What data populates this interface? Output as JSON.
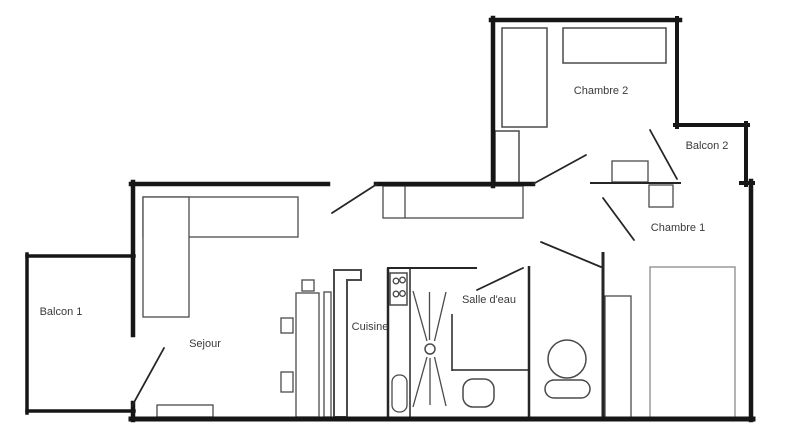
{
  "canvas": {
    "width": 800,
    "height": 447,
    "background": "#ffffff"
  },
  "colors": {
    "wall": "#161616",
    "interior_wall": "#262626",
    "furniture": "#4a4a4a",
    "furniture_light": "#8a8a8a",
    "label": "#3a3a3a",
    "fill": "#ffffff"
  },
  "rooms": [
    {
      "id": "balcon-1",
      "label": "Balcon 1",
      "x": 61,
      "y": 315
    },
    {
      "id": "sejour",
      "label": "Sejour",
      "x": 205,
      "y": 347
    },
    {
      "id": "cuisine",
      "label": "Cuisine",
      "x": 370,
      "y": 330
    },
    {
      "id": "salle-deau",
      "label": "Salle d'eau",
      "x": 489,
      "y": 303
    },
    {
      "id": "chambre-2",
      "label": "Chambre 2",
      "x": 601,
      "y": 94
    },
    {
      "id": "balcon-2",
      "label": "Balcon 2",
      "x": 707,
      "y": 149
    },
    {
      "id": "chambre-1",
      "label": "Chambre 1",
      "x": 678,
      "y": 231
    }
  ],
  "walls": {
    "exterior": [
      {
        "name": "wall-chambre2-top",
        "x1": 491,
        "y1": 20,
        "x2": 680,
        "y2": 20,
        "w": 4.5
      },
      {
        "name": "wall-chambre2-left",
        "x1": 493,
        "y1": 18,
        "x2": 493,
        "y2": 186,
        "w": 4.5
      },
      {
        "name": "wall-chambre2-right",
        "x1": 677,
        "y1": 18,
        "x2": 677,
        "y2": 127,
        "w": 4
      },
      {
        "name": "wall-balcon2-top",
        "x1": 675,
        "y1": 125,
        "x2": 748,
        "y2": 125,
        "w": 4
      },
      {
        "name": "wall-balcon2-right",
        "x1": 746,
        "y1": 123,
        "x2": 746,
        "y2": 185,
        "w": 4
      },
      {
        "name": "wall-right-jog",
        "x1": 741,
        "y1": 183,
        "x2": 753,
        "y2": 183,
        "w": 4
      },
      {
        "name": "wall-apartment-right",
        "x1": 751,
        "y1": 181,
        "x2": 751,
        "y2": 420,
        "w": 4.5
      },
      {
        "name": "wall-apartment-bottom",
        "x1": 131,
        "y1": 419,
        "x2": 753,
        "y2": 419,
        "w": 5
      },
      {
        "name": "wall-sejour-top",
        "x1": 131,
        "y1": 184,
        "x2": 328,
        "y2": 184,
        "w": 4.5
      },
      {
        "name": "wall-hall-top",
        "x1": 376,
        "y1": 184,
        "x2": 533,
        "y2": 184,
        "w": 4.5
      },
      {
        "name": "wall-apartment-left",
        "x1": 133,
        "y1": 182,
        "x2": 133,
        "y2": 335,
        "w": 4.5
      },
      {
        "name": "wall-left-stub",
        "x1": 133,
        "y1": 403,
        "x2": 133,
        "y2": 420,
        "w": 4.5
      },
      {
        "name": "wall-balcon1-top",
        "x1": 27,
        "y1": 256,
        "x2": 134,
        "y2": 256,
        "w": 3.5
      },
      {
        "name": "wall-balcon1-left",
        "x1": 27,
        "y1": 254,
        "x2": 27,
        "y2": 413,
        "w": 3.5
      },
      {
        "name": "wall-balcon1-bottom",
        "x1": 27,
        "y1": 411,
        "x2": 134,
        "y2": 411,
        "w": 3.5
      }
    ],
    "interior": [
      {
        "name": "wall-chambre1-top",
        "x1": 590,
        "y1": 183,
        "x2": 681,
        "y2": 183,
        "w": 2
      },
      {
        "name": "wall-wc-left",
        "x1": 529,
        "y1": 266,
        "x2": 529,
        "y2": 418,
        "w": 2.5
      },
      {
        "name": "wall-chambre1-left",
        "x1": 603,
        "y1": 252,
        "x2": 603,
        "y2": 418,
        "w": 3
      },
      {
        "name": "wall-cuisine-left",
        "x1": 388,
        "y1": 268,
        "x2": 388,
        "y2": 417,
        "w": 2.5
      },
      {
        "name": "wall-cuisine-top",
        "x1": 387,
        "y1": 268,
        "x2": 477,
        "y2": 268,
        "w": 2
      },
      {
        "name": "wall-shower-left",
        "x1": 410,
        "y1": 268,
        "x2": 410,
        "y2": 417,
        "w": 1.5
      },
      {
        "name": "wall-toilet-nook-v",
        "x1": 452,
        "y1": 314,
        "x2": 452,
        "y2": 371,
        "w": 1.5
      },
      {
        "name": "wall-toilet-nook-h",
        "x1": 452,
        "y1": 370,
        "x2": 529,
        "y2": 370,
        "w": 1.5
      }
    ]
  },
  "doors": [
    {
      "name": "door-balcon1",
      "x1": 132,
      "y1": 406,
      "x2": 164,
      "y2": 348
    },
    {
      "name": "door-entry",
      "x1": 332,
      "y1": 213,
      "x2": 377,
      "y2": 184
    },
    {
      "name": "door-chambre2",
      "x1": 533,
      "y1": 184,
      "x2": 586,
      "y2": 155
    },
    {
      "name": "door-balcon2",
      "x1": 650,
      "y1": 130,
      "x2": 677,
      "y2": 179
    },
    {
      "name": "door-chambre1",
      "x1": 603,
      "y1": 198,
      "x2": 634,
      "y2": 240
    },
    {
      "name": "door-wc",
      "x1": 541,
      "y1": 242,
      "x2": 601,
      "y2": 267
    },
    {
      "name": "door-salle-deau",
      "x1": 477,
      "y1": 290,
      "x2": 523,
      "y2": 268
    }
  ],
  "furniture": [
    {
      "name": "sofa-long",
      "type": "rect",
      "x": 143,
      "y": 197,
      "w": 155,
      "h": 40
    },
    {
      "name": "sofa-chaise",
      "type": "rect",
      "x": 143,
      "y": 197,
      "w": 46,
      "h": 120
    },
    {
      "name": "rug",
      "type": "rect",
      "x": 157,
      "y": 405,
      "w": 56,
      "h": 12
    },
    {
      "name": "hall-sideboard",
      "type": "rect",
      "x": 383,
      "y": 186,
      "w": 140,
      "h": 32
    },
    {
      "name": "hall-sideboard-divider",
      "type": "line",
      "x1": 405,
      "y1": 186,
      "x2": 405,
      "y2": 218
    },
    {
      "name": "kitchen-box-top",
      "type": "rect",
      "x": 302,
      "y": 280,
      "w": 12,
      "h": 11
    },
    {
      "name": "kitchen-box-mid",
      "type": "rect",
      "x": 281,
      "y": 318,
      "w": 12,
      "h": 15
    },
    {
      "name": "kitchen-box-low",
      "type": "rect",
      "x": 281,
      "y": 372,
      "w": 12,
      "h": 20
    },
    {
      "name": "kitchen-counter",
      "type": "rect",
      "x": 296,
      "y": 293,
      "w": 23,
      "h": 124
    },
    {
      "name": "kitchen-slim-unit",
      "type": "rect",
      "x": 324,
      "y": 292,
      "w": 7,
      "h": 125
    },
    {
      "name": "kitchen-l-unit",
      "type": "polygon",
      "points": "334,270 361,270 361,280 347,280 347,417 334,417",
      "sw": 2
    },
    {
      "name": "stove",
      "type": "rect",
      "x": 390,
      "y": 273,
      "w": 17,
      "h": 32,
      "sw": 1.5
    },
    {
      "name": "stove-burner-1",
      "type": "circle",
      "cx": 396,
      "cy": 281,
      "r": 2.8
    },
    {
      "name": "stove-burner-2",
      "type": "circle",
      "cx": 402.5,
      "cy": 280,
      "r": 2.8
    },
    {
      "name": "stove-burner-3",
      "type": "circle",
      "cx": 396,
      "cy": 294,
      "r": 2.8
    },
    {
      "name": "stove-burner-4",
      "type": "circle",
      "cx": 402.5,
      "cy": 293.5,
      "r": 2.8
    },
    {
      "name": "kitchen-sink",
      "type": "rrect",
      "x": 392,
      "y": 375,
      "w": 15,
      "h": 37,
      "rx": 7,
      "sw": 1.3
    },
    {
      "name": "shower-ray-1",
      "type": "line",
      "x1": 413,
      "y1": 291,
      "x2": 427,
      "y2": 341
    },
    {
      "name": "shower-ray-2",
      "type": "line",
      "x1": 429.5,
      "y1": 292,
      "x2": 429.5,
      "y2": 340
    },
    {
      "name": "shower-ray-3",
      "type": "line",
      "x1": 446,
      "y1": 292,
      "x2": 434.5,
      "y2": 341
    },
    {
      "name": "shower-ray-4",
      "type": "line",
      "x1": 413,
      "y1": 407,
      "x2": 427,
      "y2": 357
    },
    {
      "name": "shower-ray-5",
      "type": "line",
      "x1": 430,
      "y1": 405,
      "x2": 430,
      "y2": 358
    },
    {
      "name": "shower-ray-6",
      "type": "line",
      "x1": 446,
      "y1": 406,
      "x2": 434.5,
      "y2": 357
    },
    {
      "name": "shower-drain",
      "type": "circle",
      "cx": 430,
      "cy": 349,
      "r": 5,
      "sw": 1.5
    },
    {
      "name": "toilet",
      "type": "rrect",
      "x": 463,
      "y": 379,
      "w": 31,
      "h": 28,
      "rx": 10,
      "sw": 1.5
    },
    {
      "name": "washbasin-bowl",
      "type": "circle",
      "cx": 567,
      "cy": 359,
      "r": 19,
      "sw": 1.5
    },
    {
      "name": "washbasin-base",
      "type": "rrect",
      "x": 545,
      "y": 380,
      "w": 45,
      "h": 18,
      "rx": 9,
      "sw": 1.5
    },
    {
      "name": "chambre1-closet",
      "type": "rect",
      "x": 605,
      "y": 296,
      "w": 26,
      "h": 122
    },
    {
      "name": "chambre1-bed",
      "type": "rect",
      "x": 650,
      "y": 267,
      "w": 85,
      "h": 151,
      "light": true
    },
    {
      "name": "chambre1-desk",
      "type": "rect",
      "x": 612,
      "y": 161,
      "w": 36,
      "h": 21
    },
    {
      "name": "chambre1-nightstand",
      "type": "rect",
      "x": 649,
      "y": 185,
      "w": 24,
      "h": 22
    },
    {
      "name": "chambre2-bed",
      "type": "rect",
      "x": 502,
      "y": 28,
      "w": 45,
      "h": 99,
      "sw": 1.5
    },
    {
      "name": "chambre2-shelf",
      "type": "rect",
      "x": 563,
      "y": 28,
      "w": 103,
      "h": 35,
      "sw": 1.5
    },
    {
      "name": "corridor-wardrobe",
      "type": "rect",
      "x": 495,
      "y": 131,
      "w": 24,
      "h": 52,
      "sw": 1.5
    }
  ]
}
